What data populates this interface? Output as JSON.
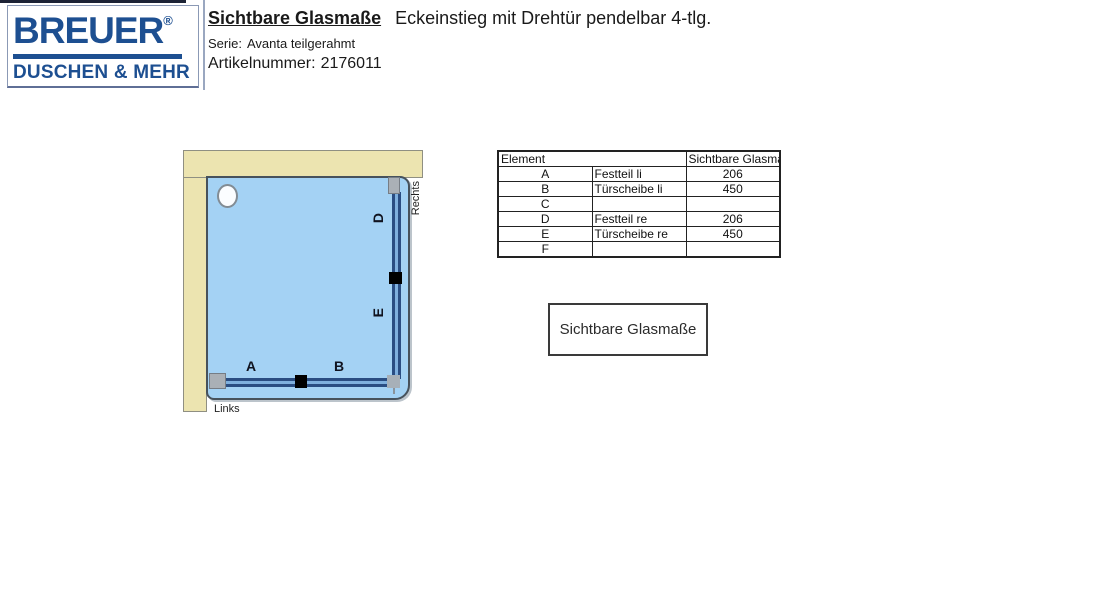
{
  "logo": {
    "brand": "BREUER",
    "registered": "®",
    "tagline": "DUSCHEN & MEHR",
    "brand_color": "#1d4f91"
  },
  "header": {
    "title": "Sichtbare Glasmaße",
    "subtitle": "Eckeinstieg mit Drehtür pendelbar 4-tlg.",
    "series_label": "Serie:",
    "series_value": "Avanta teilgerahmt",
    "article_label": "Artikelnummer:",
    "article_value": "2176011"
  },
  "diagram": {
    "labels": {
      "a": "A",
      "b": "B",
      "d": "D",
      "e": "E",
      "left": "Links",
      "right": "Rechts"
    },
    "colors": {
      "wall": "#ece4b0",
      "tray": "#a4d2f4",
      "glass_dark": "#2a4d82",
      "glass_light": "#7fb0de",
      "profile": "#aab0b6",
      "hinge": "#000000"
    }
  },
  "table": {
    "header": {
      "element": "Element",
      "value": "Sichtbare Glasmaße"
    },
    "rows": [
      {
        "letter": "A",
        "element": "Festteil li",
        "value": "206"
      },
      {
        "letter": "B",
        "element": "Türscheibe li",
        "value": "450"
      },
      {
        "letter": "C",
        "element": "",
        "value": ""
      },
      {
        "letter": "D",
        "element": "Festteil re",
        "value": "206"
      },
      {
        "letter": "E",
        "element": "Türscheibe re",
        "value": "450"
      },
      {
        "letter": "F",
        "element": "",
        "value": ""
      }
    ]
  },
  "legend_box": {
    "label": "Sichtbare Glasmaße"
  }
}
